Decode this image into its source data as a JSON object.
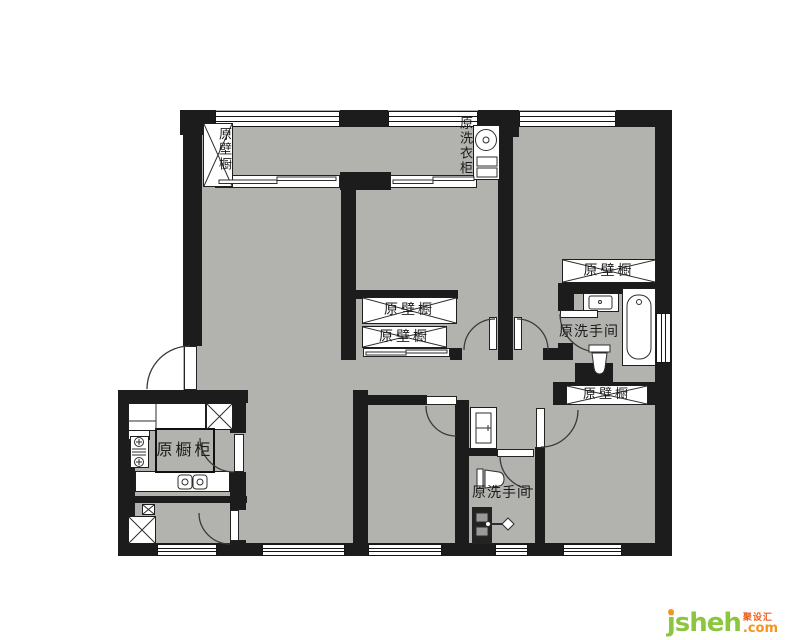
{
  "plan": {
    "labels": [
      {
        "id": "balcony-closet",
        "text": "原壁橱",
        "orientation": "vertical"
      },
      {
        "id": "laundry-cabinet",
        "text": "原洗衣柜",
        "orientation": "vertical"
      },
      {
        "id": "closet-northeast",
        "text": "原壁橱",
        "orientation": "horizontal"
      },
      {
        "id": "bathroom-main",
        "text": "原洗手间",
        "orientation": "horizontal"
      },
      {
        "id": "closet-middle-upper",
        "text": "原壁橱",
        "orientation": "horizontal"
      },
      {
        "id": "closet-middle-lower",
        "text": "原壁橱",
        "orientation": "horizontal"
      },
      {
        "id": "closet-southeast",
        "text": "原壁橱",
        "orientation": "horizontal"
      },
      {
        "id": "kitchen-cabinet",
        "text": "原橱柜",
        "orientation": "horizontal"
      },
      {
        "id": "bathroom-small",
        "text": "原洗手间",
        "orientation": "horizontal"
      }
    ],
    "colors": {
      "floor": "#b2b2af",
      "wall": "#1c1c1c",
      "line": "#3a3a3a",
      "logo-green": "#8cc63e",
      "logo-orange": "#f7941d",
      "logo-red": "#ee5f1e"
    }
  },
  "watermark": {
    "brand": "jsheh",
    "cjk": "聚设汇",
    "tld": ".com"
  }
}
